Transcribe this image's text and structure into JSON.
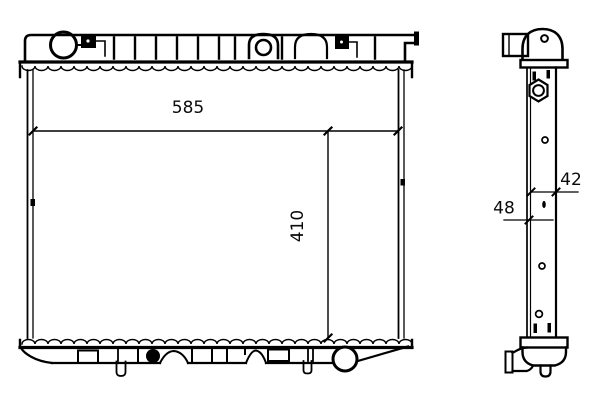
{
  "diagram": {
    "subject": "radiator-two-view-technical-drawing",
    "background_color": "#ffffff",
    "line_color": "#000000",
    "views": {
      "front": {
        "name": "front-view"
      },
      "side": {
        "name": "side-view"
      }
    },
    "dimensions": {
      "width": {
        "label": "585"
      },
      "height": {
        "label": "410"
      },
      "core_depth": {
        "label": "42"
      },
      "overall_depth": {
        "label": "48"
      }
    }
  }
}
